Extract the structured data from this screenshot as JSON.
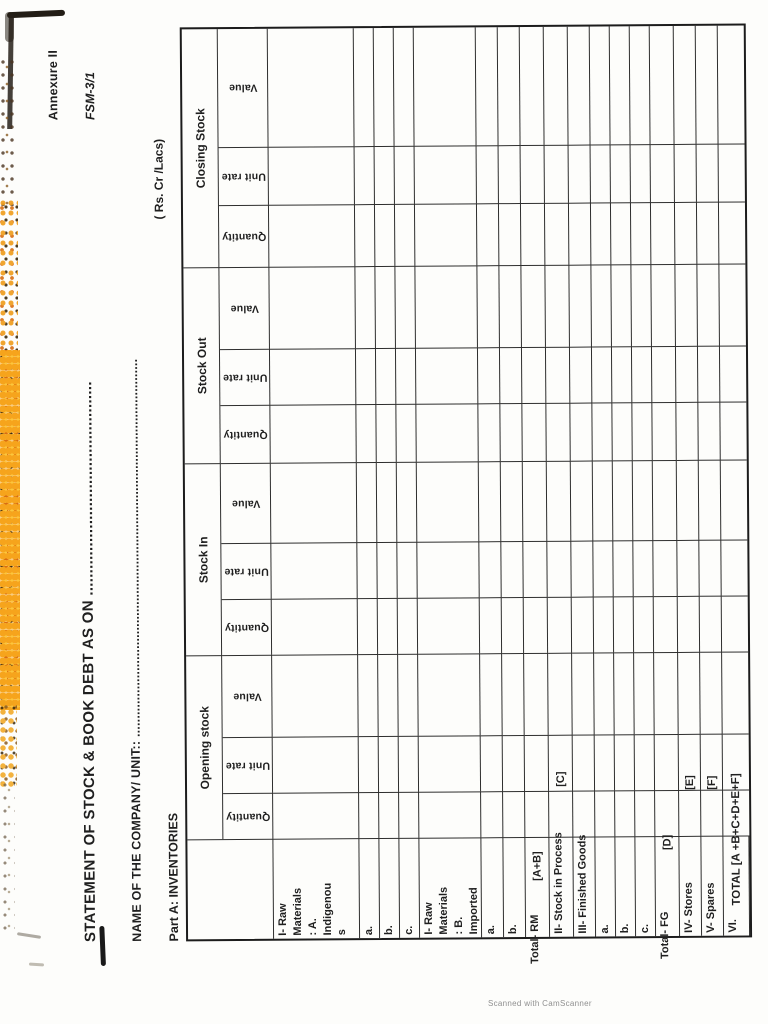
{
  "page": {
    "annexure": "Annexure II",
    "form_no": "FSM-3/1",
    "title": "STATEMENT OF STOCK & BOOK DEBT AS ON ................................................",
    "company_line": "NAME OF THE COMPANY/ UNIT:: .......................................................................................................",
    "part_label": "Part A: INVENTORIES",
    "units_note": "( Rs. Cr /Lacs)"
  },
  "table": {
    "groups": [
      "Opening stock",
      "Stock In",
      "Stock Out",
      "Closing Stock"
    ],
    "sub_headers": [
      "Quantity",
      "Unit rate",
      "Value"
    ],
    "rows": [
      {
        "label": "I- Raw\nMaterials\n: A.\nIndigenou\ns"
      },
      {
        "label": "a."
      },
      {
        "label": "b."
      },
      {
        "label": "c."
      },
      {
        "label": "I- Raw\nMaterials\n: B.\nImported"
      },
      {
        "label": "a."
      },
      {
        "label": "b."
      },
      {
        "label": "Total- RM",
        "ref": "[A+B]"
      },
      {
        "label": "II- Stock in Process",
        "ref": "[C]"
      },
      {
        "label": "III- Finished Goods"
      },
      {
        "label": "a."
      },
      {
        "label": "b."
      },
      {
        "label": "c."
      },
      {
        "label": "Total- FG",
        "ref": "[D]"
      },
      {
        "label": "IV- Stores",
        "ref": "[E]"
      },
      {
        "label": "V- Spares",
        "ref": "[F]"
      },
      {
        "label": "VI.",
        "ref": "TOTAL [A +B+C+D+E+F]"
      }
    ],
    "data_cells": "empty"
  },
  "footer": {
    "watermark": "Scanned with CamScanner"
  },
  "colors": {
    "ink": "#1f1f1f",
    "paper": "#fdfdfb",
    "speckle_orange": "#f6a41c",
    "speckle_yellow": "#fcc63d",
    "speckle_dark": "#38280f"
  }
}
